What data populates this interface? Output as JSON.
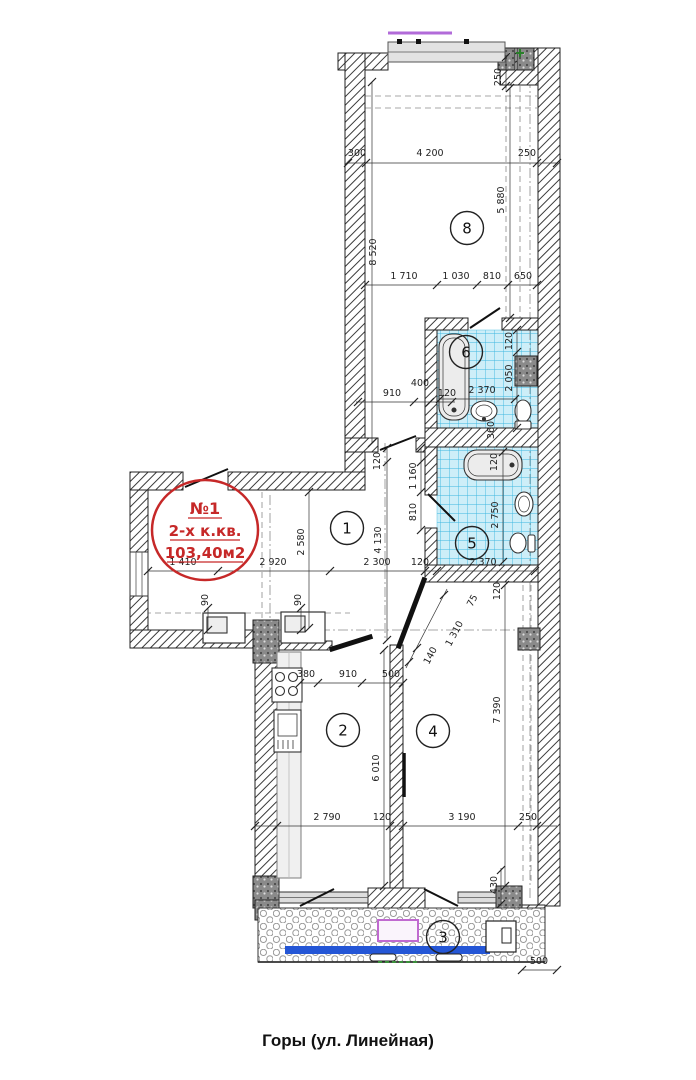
{
  "caption": "Горы (ул. Линейная)",
  "stamp": {
    "number": "№1",
    "type": "2-х к.кв.",
    "area": "103,40м2",
    "color": "#c62828"
  },
  "rooms": [
    {
      "id": "1",
      "x": 347,
      "y": 528
    },
    {
      "id": "2",
      "x": 343,
      "y": 730
    },
    {
      "id": "3",
      "x": 443,
      "y": 937
    },
    {
      "id": "4",
      "x": 433,
      "y": 731
    },
    {
      "id": "5",
      "x": 472,
      "y": 543
    },
    {
      "id": "6",
      "x": 466,
      "y": 352
    },
    {
      "id": "8",
      "x": 467,
      "y": 228
    }
  ],
  "dimensions": [
    {
      "text": "300",
      "x": 357,
      "y": 156,
      "rot": 0
    },
    {
      "text": "4 200",
      "x": 430,
      "y": 156,
      "rot": 0
    },
    {
      "text": "250",
      "x": 527,
      "y": 156,
      "rot": 0
    },
    {
      "text": "1 710",
      "x": 404,
      "y": 279,
      "rot": 0
    },
    {
      "text": "1 030",
      "x": 456,
      "y": 279,
      "rot": 0
    },
    {
      "text": "810",
      "x": 492,
      "y": 279,
      "rot": 0
    },
    {
      "text": "650",
      "x": 523,
      "y": 279,
      "rot": 0
    },
    {
      "text": "910",
      "x": 392,
      "y": 396,
      "rot": 0
    },
    {
      "text": "400",
      "x": 420,
      "y": 386,
      "rot": 0
    },
    {
      "text": "120",
      "x": 447,
      "y": 396,
      "rot": 0
    },
    {
      "text": "2 370",
      "x": 482,
      "y": 393,
      "rot": 0
    },
    {
      "text": "1 410",
      "x": 183,
      "y": 565,
      "rot": 0
    },
    {
      "text": "2 920",
      "x": 273,
      "y": 565,
      "rot": 0
    },
    {
      "text": "2 300",
      "x": 377,
      "y": 565,
      "rot": 0
    },
    {
      "text": "120",
      "x": 420,
      "y": 565,
      "rot": 0
    },
    {
      "text": "2 370",
      "x": 483,
      "y": 565,
      "rot": 0
    },
    {
      "text": "380",
      "x": 306,
      "y": 677,
      "rot": 0
    },
    {
      "text": "910",
      "x": 348,
      "y": 677,
      "rot": 0
    },
    {
      "text": "500",
      "x": 391,
      "y": 677,
      "rot": 0
    },
    {
      "text": "2 790",
      "x": 327,
      "y": 820,
      "rot": 0
    },
    {
      "text": "120",
      "x": 382,
      "y": 820,
      "rot": 0
    },
    {
      "text": "3 190",
      "x": 462,
      "y": 820,
      "rot": 0
    },
    {
      "text": "250",
      "x": 528,
      "y": 820,
      "rot": 0
    },
    {
      "text": "500",
      "x": 539,
      "y": 964,
      "rot": 0
    },
    {
      "text": "250",
      "x": 501,
      "y": 77,
      "rot": -90
    },
    {
      "text": "5 880",
      "x": 504,
      "y": 200,
      "rot": -90
    },
    {
      "text": "8 520",
      "x": 376,
      "y": 252,
      "rot": -90
    },
    {
      "text": "120",
      "x": 512,
      "y": 341,
      "rot": -90
    },
    {
      "text": "2 050",
      "x": 512,
      "y": 378,
      "rot": -90
    },
    {
      "text": "360",
      "x": 494,
      "y": 430,
      "rot": -90
    },
    {
      "text": "120",
      "x": 380,
      "y": 461,
      "rot": -90
    },
    {
      "text": "1 160",
      "x": 416,
      "y": 476,
      "rot": -90
    },
    {
      "text": "810",
      "x": 416,
      "y": 512,
      "rot": -90
    },
    {
      "text": "4 130",
      "x": 381,
      "y": 540,
      "rot": -90
    },
    {
      "text": "2 580",
      "x": 304,
      "y": 542,
      "rot": -90
    },
    {
      "text": "120",
      "x": 497,
      "y": 462,
      "rot": -90
    },
    {
      "text": "2 750",
      "x": 498,
      "y": 515,
      "rot": -90
    },
    {
      "text": "120",
      "x": 500,
      "y": 591,
      "rot": -90
    },
    {
      "text": "90",
      "x": 208,
      "y": 600,
      "rot": -90
    },
    {
      "text": "90",
      "x": 301,
      "y": 600,
      "rot": -90
    },
    {
      "text": "6 010",
      "x": 379,
      "y": 768,
      "rot": -90
    },
    {
      "text": "7 390",
      "x": 500,
      "y": 710,
      "rot": -90
    },
    {
      "text": "430",
      "x": 497,
      "y": 885,
      "rot": -90
    },
    {
      "text": "140",
      "x": 433,
      "y": 657,
      "rot": -62
    },
    {
      "text": "1 310",
      "x": 457,
      "y": 635,
      "rot": -62
    },
    {
      "text": "75",
      "x": 475,
      "y": 602,
      "rot": -62
    }
  ],
  "colors": {
    "stamp_red": "#c62828",
    "tile_blue": "#cdeef8",
    "tile_grid": "#3bb7e0",
    "accent_blue_bar": "#2456d6",
    "accent_purple": "#b26bd9",
    "wall_line": "#222222"
  }
}
